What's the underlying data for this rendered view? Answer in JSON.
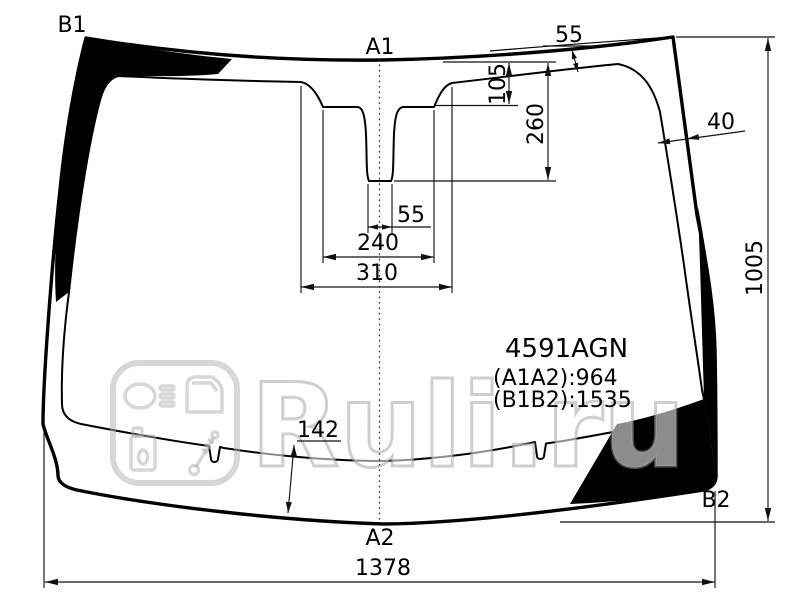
{
  "title": "Windshield dimensions diagram",
  "part": {
    "code": "4591AGN",
    "a1a2_line": "(A1A2):964",
    "b1b2_line": "(B1B2):1535"
  },
  "ref_points": {
    "top_left": "B1",
    "top_center": "A1",
    "bottom_center": "A2",
    "bottom_right": "B2"
  },
  "dims": {
    "top_edge_gap": "55",
    "band_step_drop": "105",
    "mirror_pocket_depth": "260",
    "right_band_width": "40",
    "glass_height": "1005",
    "mirror_base_width": "55",
    "mirror_mid_width": "240",
    "mirror_outer_width": "310",
    "bottom_band_height": "142",
    "glass_width": "1378"
  },
  "watermark": {
    "brand": "Ruli.ru"
  },
  "colors": {
    "line": "#000000",
    "dimension": "#111111",
    "background": "#ffffff",
    "band_fill": "#000000",
    "watermark_gray": "#aaaaaa"
  }
}
